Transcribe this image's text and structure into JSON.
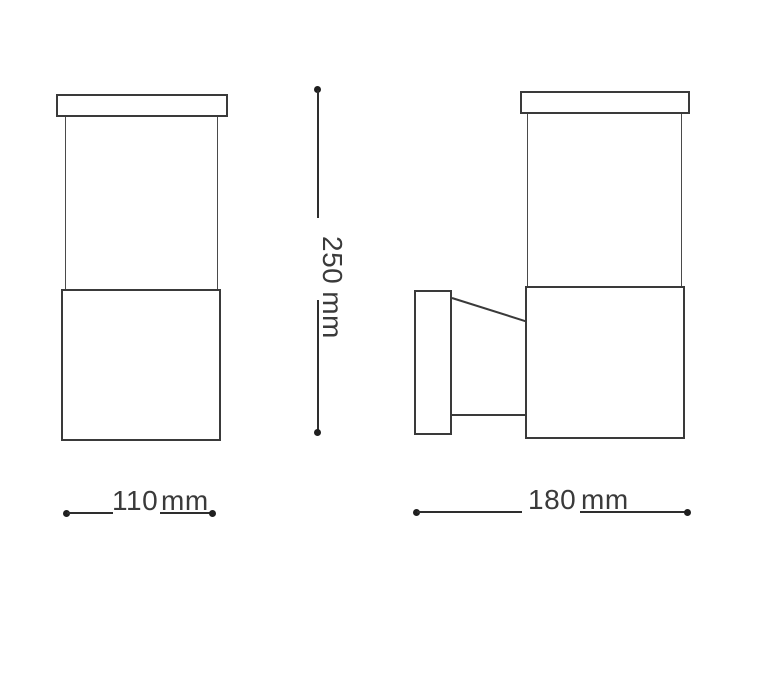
{
  "page": {
    "description": "Technical dimension drawing of a wall-mounted lamp, front view and side view"
  },
  "dimensions": {
    "height": {
      "value": "250",
      "unit": "mm"
    },
    "width": {
      "value": "110",
      "unit": "mm"
    },
    "depth": {
      "value": "180",
      "unit": "mm"
    }
  },
  "colors": {
    "line": "#3a3a3a",
    "dot": "#1f1f1f",
    "text": "#3a3a3a",
    "background": "#ffffff"
  }
}
